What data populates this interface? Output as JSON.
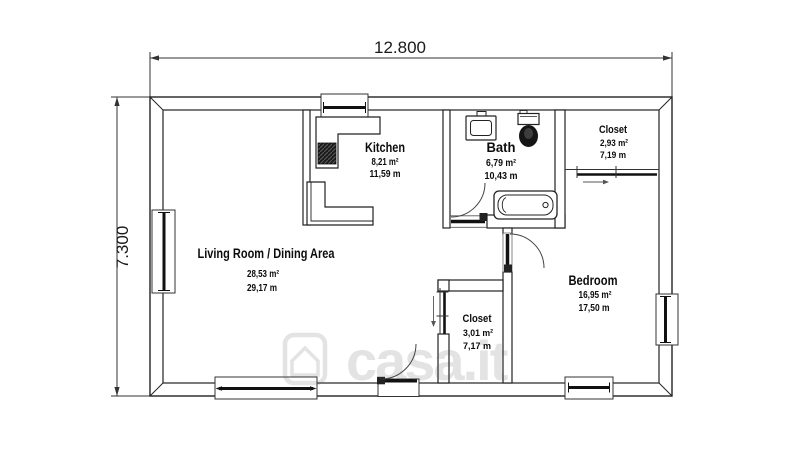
{
  "dimensions": {
    "width": "12.800",
    "height": "7.300"
  },
  "rooms": {
    "living": {
      "name": "Living Room / Dining Area",
      "area": "28,53 m²",
      "perimeter": "29,17 m"
    },
    "kitchen": {
      "name": "Kitchen",
      "area": "8,21 m²",
      "perimeter": "11,59 m"
    },
    "bath": {
      "name": "Bath",
      "area": "6,79 m²",
      "perimeter": "10,43 m"
    },
    "closet_top": {
      "name": "Closet",
      "area": "2,93 m²",
      "perimeter": "7,19 m"
    },
    "bedroom": {
      "name": "Bedroom",
      "area": "16,95 m²",
      "perimeter": "17,50 m"
    },
    "closet_bottom": {
      "name": "Closet",
      "area": "3,01 m²",
      "perimeter": "7,17 m"
    }
  },
  "watermark": {
    "text": "casa.it"
  },
  "colors": {
    "line": "#222222",
    "text": "#0c0c0c",
    "watermark_gray": "#e9e9e9"
  }
}
